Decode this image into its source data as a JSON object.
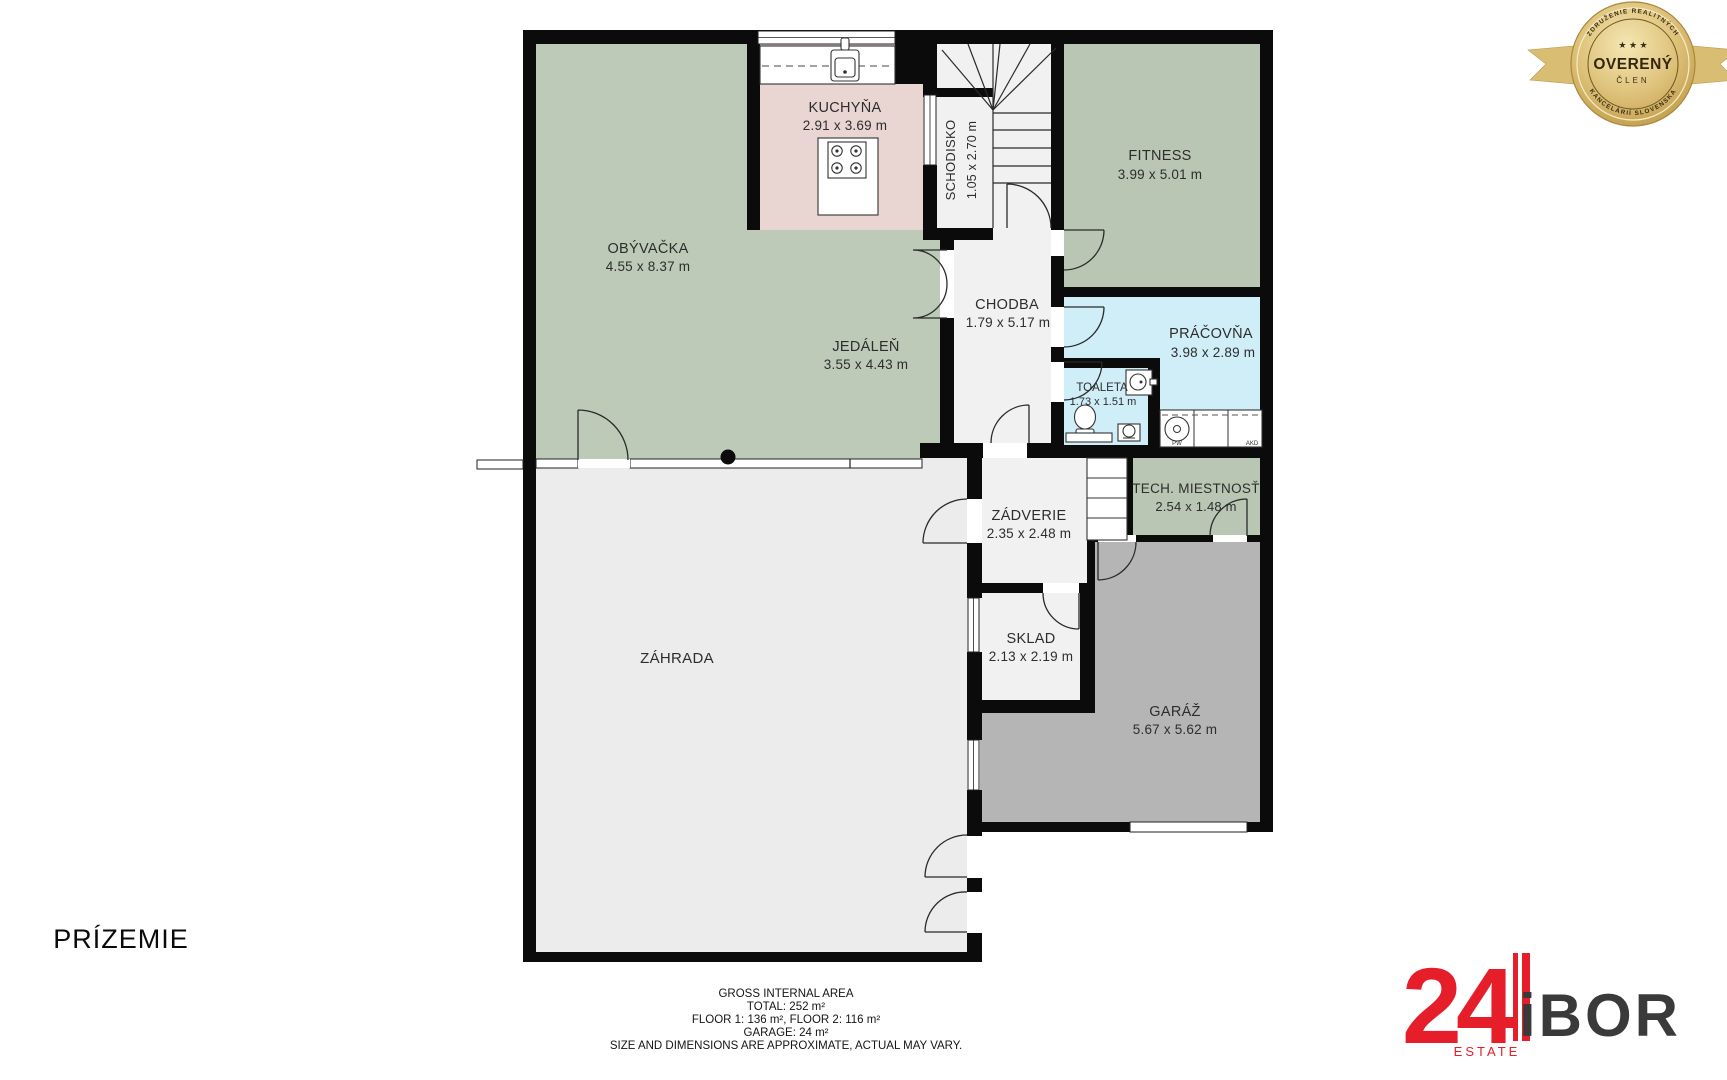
{
  "floor_label": "PRÍZEMIE",
  "rooms": {
    "obyvacka": {
      "name": "OBÝVAČKA",
      "dims": "4.55 x 8.37 m"
    },
    "jedalen": {
      "name": "JEDÁLEŇ",
      "dims": "3.55 x 4.43 m"
    },
    "kuchyna": {
      "name": "KUCHYŇA",
      "dims": "2.91 x 3.69 m"
    },
    "schodisko": {
      "name": "SCHODISKO",
      "dims": "1.05 x 2.70 m"
    },
    "fitness": {
      "name": "FITNESS",
      "dims": "3.99 x 5.01 m"
    },
    "chodba": {
      "name": "CHODBA",
      "dims": "1.79 x 5.17 m"
    },
    "pracovna": {
      "name": "PRÁČOVŇA",
      "dims": "3.98 x 2.89 m"
    },
    "toaleta": {
      "name": "TOALETA",
      "dims": "1.73 x 1.51 m"
    },
    "zadverie": {
      "name": "ZÁDVERIE",
      "dims": "2.35 x 2.48 m"
    },
    "tech_miestnost": {
      "name": "TECH. MIESTNOSŤ",
      "dims": "2.54 x 1.48 m"
    },
    "sklad": {
      "name": "SKLAD",
      "dims": "2.13 x 2.19 m"
    },
    "garaz": {
      "name": "GARÁŽ",
      "dims": "5.67 x 5.62 m"
    },
    "zahrada": {
      "name": "ZÁHRADA"
    }
  },
  "appliances": {
    "washer_label": "PW",
    "dryer_label": "AKD"
  },
  "footer": {
    "line1": "GROSS INTERNAL AREA",
    "line2": "TOTAL: 252 m²",
    "line3": "FLOOR 1: 136 m²,  FLOOR 2: 116 m²",
    "line4": "GARAGE: 24 m²",
    "line5": "SIZE AND DIMENSIONS ARE APPROXIMATE, ACTUAL MAY VARY."
  },
  "badge": {
    "arc_top": "ZDRUŽENIE REALITNÝCH",
    "arc_bottom": "KANCELÁRIÍ SLOVENSKA",
    "stars": "★ ★ ★",
    "title": "OVERENÝ",
    "subtitle": "ČLEN"
  },
  "logo": {
    "number": "24",
    "name": "iBOR",
    "tagline": "ESTATE"
  },
  "colors": {
    "living_green": "#bdcab8",
    "kitchen_pink": "#e9d6d2",
    "wet_blue": "#cfeef7",
    "garage_gray": "#b5b5b5",
    "garden_gray": "#ececec",
    "hall_gray": "#f1f1f1",
    "wall_black": "#0b0b0b",
    "logo_red": "#e61e2a",
    "badge_gold": "#d4b368"
  }
}
